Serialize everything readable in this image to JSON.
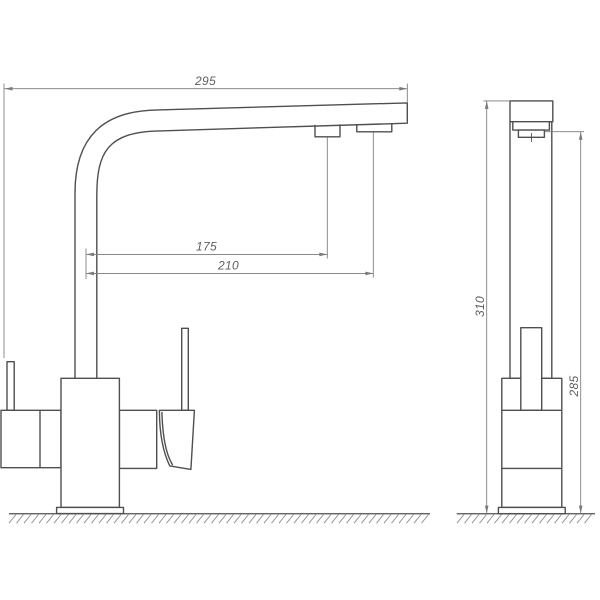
{
  "drawing": {
    "colors": {
      "outline": "#4f4f4f",
      "dim": "#7a7a7a",
      "dimtext": "#5e5e5e",
      "hatch": "#8f8f8f",
      "background": "#ffffff"
    },
    "front_view": {
      "dimensions": {
        "overall_reach": "295",
        "filtered_outlet_offset": "175",
        "main_outlet_offset": "210"
      }
    },
    "side_view": {
      "dimensions": {
        "overall_height": "310",
        "outlet_height": "285"
      }
    }
  }
}
